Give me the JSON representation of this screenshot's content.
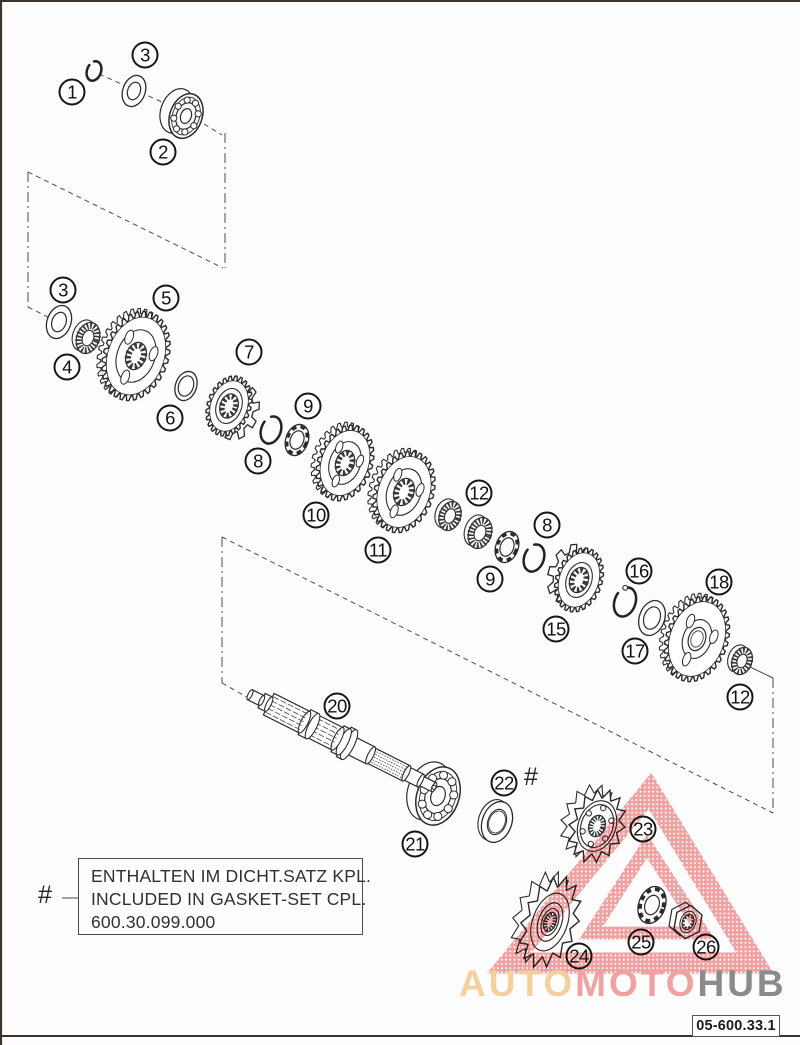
{
  "page": {
    "kind": "exploded parts diagram — transmission / countershaft",
    "background": "#fdfdfd",
    "border_color": "#3b332c"
  },
  "note_box": {
    "lines": [
      "ENTHALTEN IM DICHT.SATZ KPL.",
      "INCLUDED IN GASKET-SET CPL.",
      "600.30.099.000"
    ],
    "marker": "#"
  },
  "shaft_marker": "#",
  "drawing_number": "05-600.33.1",
  "watermark": {
    "segments": [
      {
        "text": "AUTO",
        "color": "#f7d2a0"
      },
      {
        "text": "MOTO",
        "color": "#f2a3a3"
      },
      {
        "text": "HUB",
        "color": "#8c8c8c"
      }
    ],
    "triangle_color": "#f1a1a1"
  },
  "callouts": [
    {
      "label": "1",
      "x": 72,
      "y": 92
    },
    {
      "label": "3",
      "x": 145,
      "y": 55
    },
    {
      "label": "2",
      "x": 163,
      "y": 152
    },
    {
      "label": "3",
      "x": 63,
      "y": 290
    },
    {
      "label": "5",
      "x": 166,
      "y": 298
    },
    {
      "label": "4",
      "x": 67,
      "y": 367
    },
    {
      "label": "7",
      "x": 249,
      "y": 352
    },
    {
      "label": "6",
      "x": 170,
      "y": 418
    },
    {
      "label": "9",
      "x": 308,
      "y": 406
    },
    {
      "label": "8",
      "x": 258,
      "y": 461
    },
    {
      "label": "12",
      "x": 479,
      "y": 493
    },
    {
      "label": "10",
      "x": 316,
      "y": 515
    },
    {
      "label": "8",
      "x": 547,
      "y": 525
    },
    {
      "label": "11",
      "x": 378,
      "y": 550
    },
    {
      "label": "9",
      "x": 490,
      "y": 579
    },
    {
      "label": "16",
      "x": 639,
      "y": 571
    },
    {
      "label": "18",
      "x": 719,
      "y": 582
    },
    {
      "label": "15",
      "x": 556,
      "y": 629
    },
    {
      "label": "17",
      "x": 635,
      "y": 651
    },
    {
      "label": "12",
      "x": 740,
      "y": 697
    },
    {
      "label": "20",
      "x": 337,
      "y": 706
    },
    {
      "label": "22",
      "x": 504,
      "y": 783
    },
    {
      "label": "23",
      "x": 643,
      "y": 829
    },
    {
      "label": "21",
      "x": 415,
      "y": 844
    },
    {
      "label": "25",
      "x": 641,
      "y": 942
    },
    {
      "label": "24",
      "x": 579,
      "y": 956
    },
    {
      "label": "26",
      "x": 706,
      "y": 947
    }
  ]
}
